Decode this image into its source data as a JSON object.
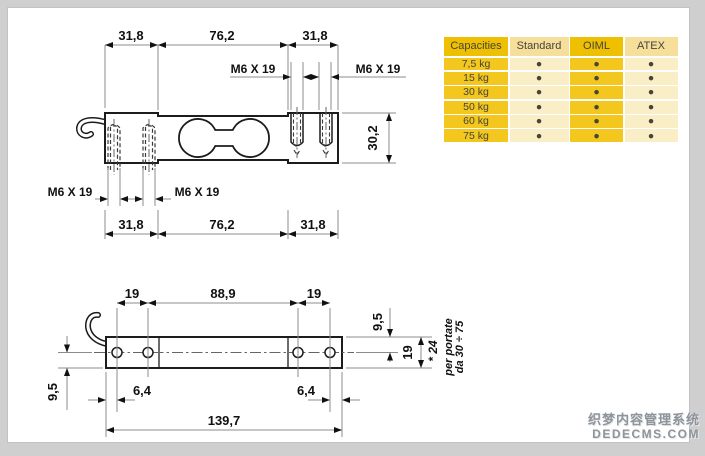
{
  "top_view": {
    "width_dims_top": [
      "31,8",
      "76,2",
      "31,8"
    ],
    "thread_specs": [
      "M6 X 19",
      "M6 X 19",
      "M6 X 19",
      "M6 X 19"
    ],
    "height_dim": "30,2",
    "width_dims_bottom": [
      "31,8",
      "76,2",
      "31,8"
    ]
  },
  "side_view": {
    "pitch_dims": [
      "19",
      "88,9",
      "19"
    ],
    "half_height_dims": [
      "9,5",
      "9,5"
    ],
    "height_dim": "19",
    "edge_dims": [
      "6,4",
      "6,4"
    ],
    "overall_dim": "139,7",
    "note_star": "* 24",
    "note_line1": "per portate",
    "note_line2": "da 30 ÷ 75"
  },
  "table": {
    "headers": [
      "Capacities",
      "Standard",
      "OIML",
      "ATEX"
    ],
    "bullet": "●",
    "rows": [
      {
        "capacity": "7,5 kg",
        "marks": [
          "●",
          "●",
          "●"
        ]
      },
      {
        "capacity": "15 kg",
        "marks": [
          "●",
          "●",
          "●"
        ]
      },
      {
        "capacity": "30 kg",
        "marks": [
          "●",
          "●",
          "●"
        ]
      },
      {
        "capacity": "50 kg",
        "marks": [
          "●",
          "●",
          "●"
        ]
      },
      {
        "capacity": "60 kg",
        "marks": [
          "●",
          "●",
          "●"
        ]
      },
      {
        "capacity": "75 kg",
        "marks": [
          "●",
          "●",
          "●"
        ]
      }
    ],
    "colors": {
      "gold_header": "#efc001",
      "gold_cell": "#f3c71d",
      "cream_header": "#f6de9b",
      "cream_cell": "#faeec6"
    }
  },
  "watermark": {
    "line1": "织梦内容管理系统",
    "line2": "DEDECMS.COM"
  }
}
